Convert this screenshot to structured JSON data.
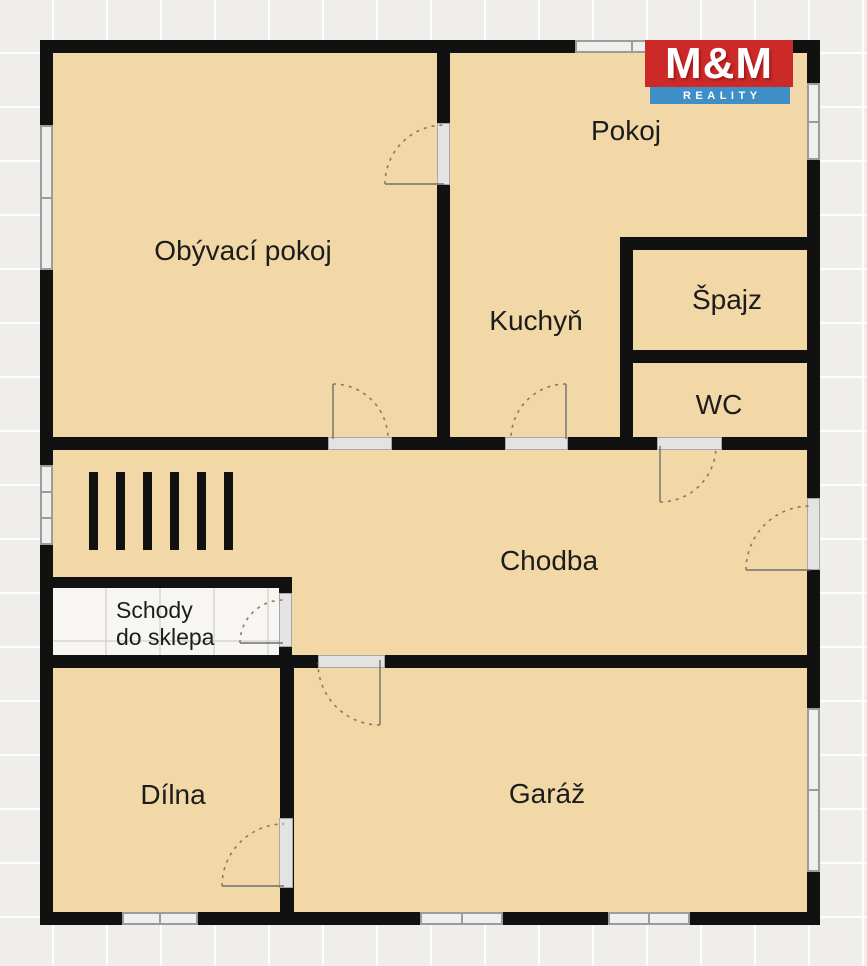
{
  "logo": {
    "name": "M&M",
    "tagline": "REALITY",
    "red": "#cb2a28",
    "blue": "#3d8fc6"
  },
  "rooms": {
    "obyvaci": {
      "label": "Obývací pokoj"
    },
    "pokoj": {
      "label": "Pokoj"
    },
    "kuchyn": {
      "label": "Kuchyň"
    },
    "spajz": {
      "label": "Špajz"
    },
    "wc": {
      "label": "WC"
    },
    "chodba": {
      "label": "Chodba"
    },
    "schody": {
      "line1": "Schody",
      "line2": "do sklepa"
    },
    "dilna": {
      "label": "Dílna"
    },
    "garaz": {
      "label": "Garáž"
    }
  },
  "stairs": {
    "bar_count": 6
  },
  "colors": {
    "room_fill": "#f1d8a6",
    "wall": "#111111",
    "background": "#efeeeb",
    "stairs_room_fill": "#f7f6f3",
    "window_fill": "#efefef",
    "window_border": "#9c9c9c",
    "door_arc": "#8f7a55",
    "logo_red": "#cb2a28",
    "logo_blue": "#3d8fc6"
  }
}
